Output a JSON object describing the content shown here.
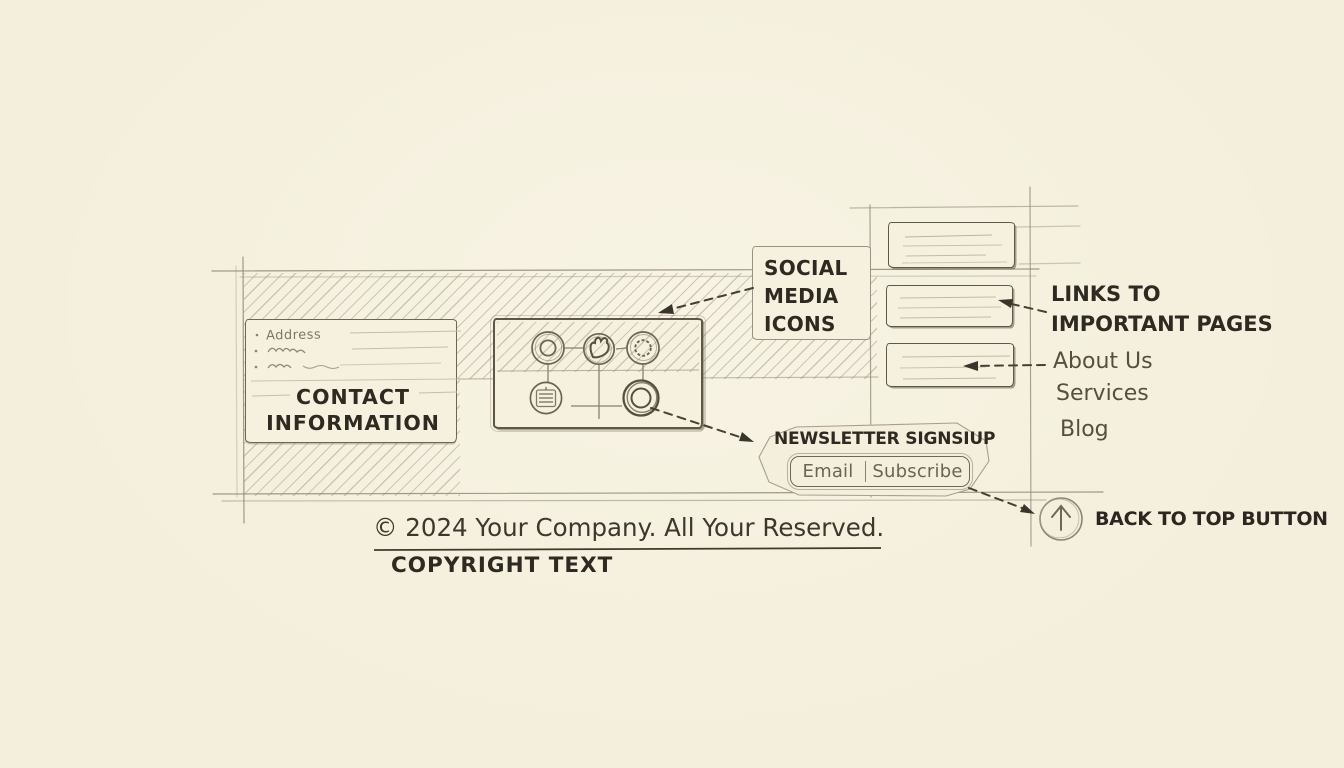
{
  "colors": {
    "paper": "#f4efdc",
    "ink": "#2e2921",
    "pencil": "#8a8170",
    "faint": "#bdb49d",
    "arrow": "#3a352b"
  },
  "footer": {
    "contact": {
      "title": "CONTACT INFORMATION",
      "address_label": "Address"
    },
    "social": {
      "label": "SOCIAL MEDIA ICONS",
      "icons": [
        "camera-lens-icon",
        "twitter-bird-icon",
        "flower-icon",
        "building-lines-icon",
        "double-ring-icon"
      ]
    },
    "links": {
      "label": "LINKS TO IMPORTANT PAGES",
      "items": [
        "About Us",
        "Services",
        "Blog"
      ]
    },
    "newsletter": {
      "label": "NEWSLETTER SIGNSIUP",
      "email_label": "Email",
      "subscribe_label": "Subscribe"
    },
    "copyright": {
      "line": "© 2024 Your Company. All Your Reserved.",
      "caption": "COPYRIGHT TEXT"
    },
    "back_to_top": {
      "label": "BACK TO TOP BUTTON"
    }
  }
}
